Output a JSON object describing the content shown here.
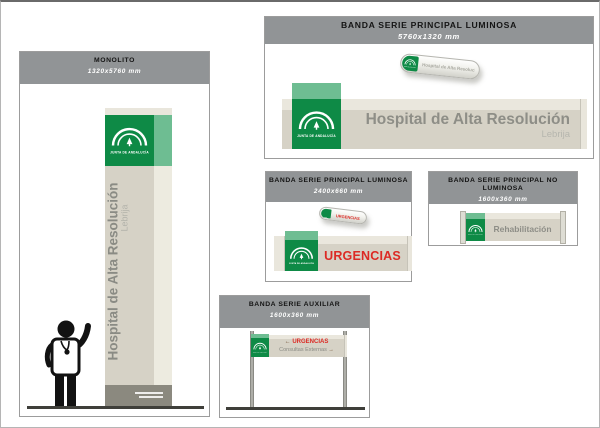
{
  "document_type": "hospital signage specification sheet",
  "colors": {
    "corporate_green": "#0e8a46",
    "green_side_light": "#6ebd92",
    "band_beige": "#d6d2c6",
    "band_top_light": "#eae7dd",
    "header_gray": "#919496",
    "sign_text_gray": "#8e8e87",
    "sign_text_light_gray": "#b6b6ae",
    "urgencias_red": "#dc2a24",
    "base_dark_gray": "#8b897f",
    "arrow_brown": "#6f4f33"
  },
  "logo": {
    "name": "junta-de-andalucia-logo",
    "label": "JUNTA DE ANDALUCÍA"
  },
  "panels": {
    "monolito": {
      "title": "MONOLITO",
      "dimensions": "1320x5760 mm",
      "sign": {
        "line1": "Hospital de Alta Resolución",
        "line2": "Lebrija"
      }
    },
    "banda_principal_grande": {
      "title": "BANDA SERIE PRINCIPAL LUMINOSA",
      "dimensions": "5760x1320 mm",
      "sign": {
        "line1": "Hospital de Alta Resolución",
        "line2": "Lebrija"
      },
      "mini_label": "Hospital de Alta Resolución"
    },
    "banda_principal_urgencias": {
      "title": "BANDA SERIE PRINCIPAL LUMINOSA",
      "dimensions": "2400x660 mm",
      "sign": {
        "text": "URGENCIAS"
      },
      "mini_label": "URGENCIAS"
    },
    "banda_no_luminosa": {
      "title": "BANDA SERIE PRINCIPAL NO LUMINOSA",
      "dimensions": "1600x360 mm",
      "sign": {
        "text": "Rehabilitación"
      }
    },
    "banda_auxiliar": {
      "title": "BANDA SERIE AUXILIAR",
      "dimensions": "1600x360 mm",
      "sign": {
        "line1_arrow": "←",
        "line1_text": "URGENCIAS",
        "line2_text": "Consultas Externas",
        "line2_arrow": "→"
      }
    }
  }
}
